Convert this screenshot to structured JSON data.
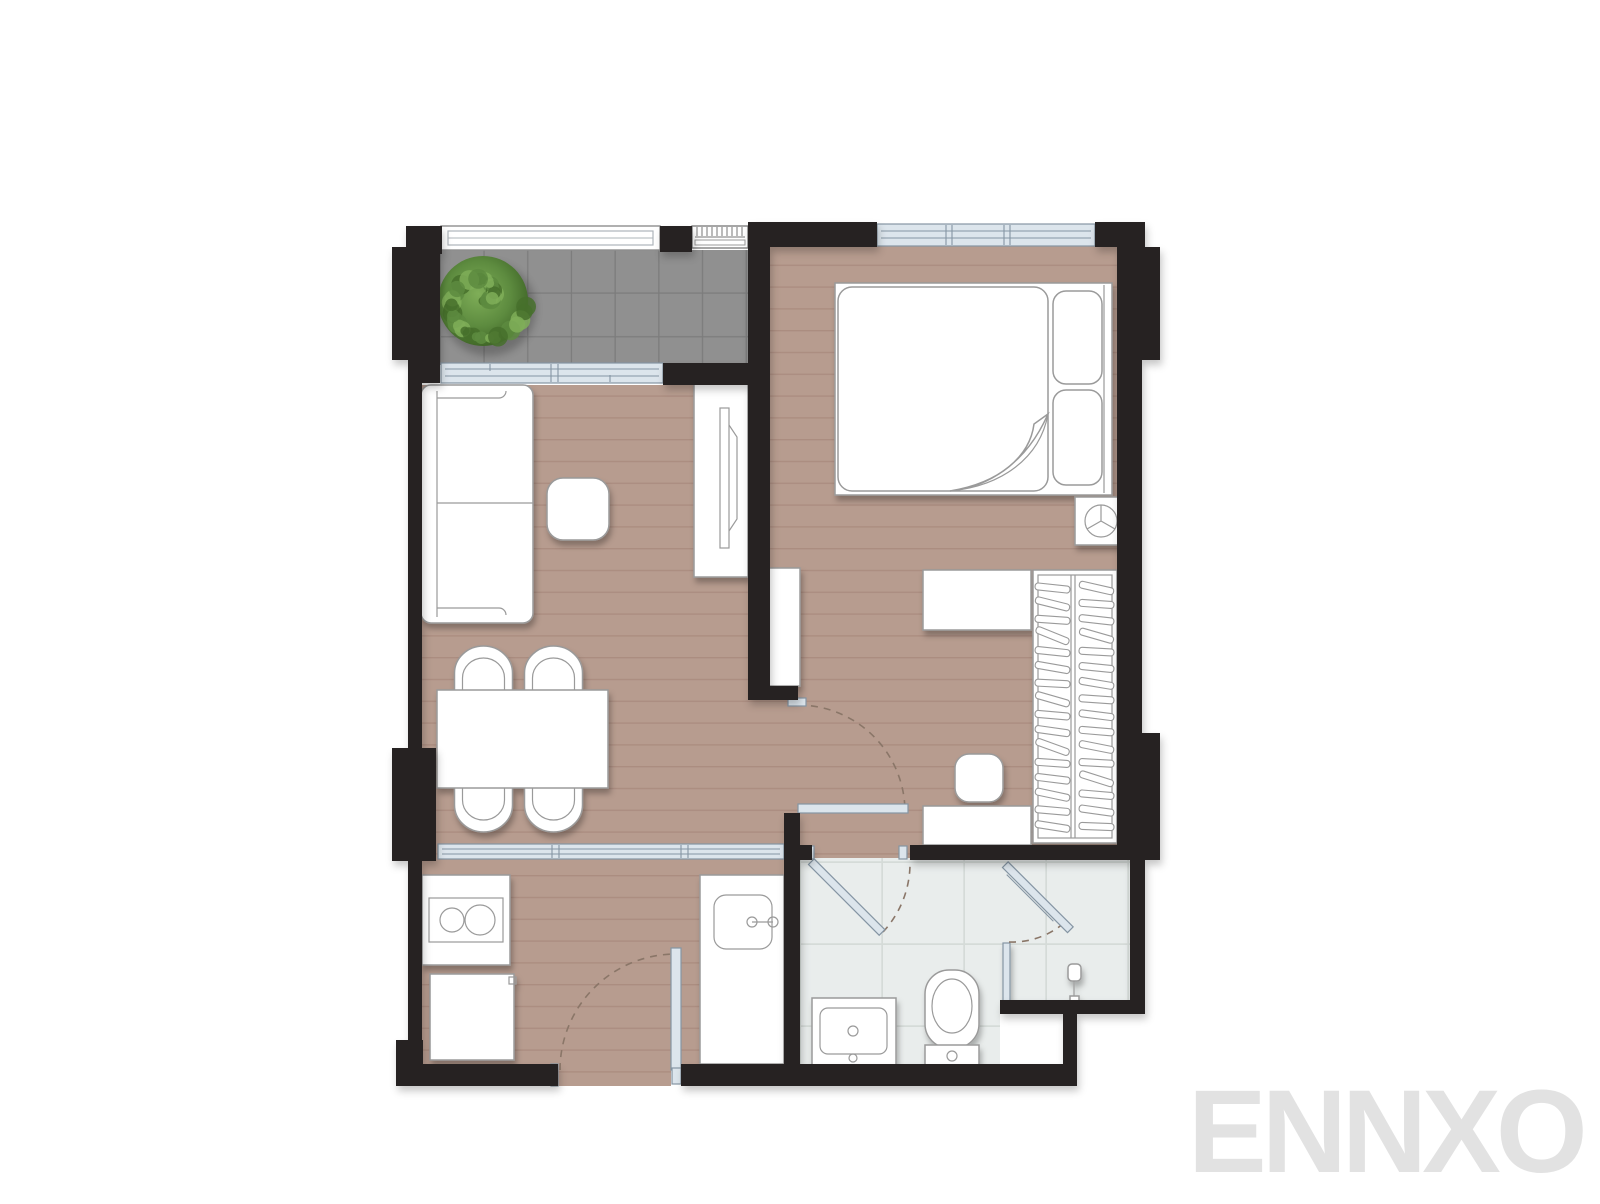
{
  "meta": {
    "watermark": "ENNXO",
    "drawing_type": "apartment-floor-plan",
    "visible_text_other_than_watermark": ""
  },
  "palette": {
    "wall": "#272320",
    "wood": "#b79c8f",
    "wood_line": "#a98b7e",
    "tile": "#909090",
    "tile_line": "#7c7c7c",
    "bath": "#e9edec",
    "bath_line": "#d5dbd8",
    "glass": "#dce5ec",
    "glass_frame": "#8595a3",
    "furn_line": "#9a9a9a",
    "dash": "#8a7668",
    "plant_dark": "#46702c",
    "plant_mid": "#5d8b3f",
    "plant_light": "#7fae58",
    "watermark": "#e2e2e2"
  },
  "rooms": [
    {
      "name": "balcony",
      "floor": "gray-tile",
      "items": [
        "potted-shrub-icon",
        "glass-railing",
        "ac-condenser-icon",
        "sliding-window"
      ]
    },
    {
      "name": "living-dining-room",
      "floor": "wood-plank",
      "items": [
        "sofa-icon",
        "coffee-table-icon",
        "tv-console-icon",
        "tv-icon",
        "dining-table-icon",
        "dining-chair-icon",
        "dining-chair-icon",
        "dining-chair-icon",
        "dining-chair-icon",
        "glass-partition"
      ]
    },
    {
      "name": "bedroom",
      "floor": "wood-plank",
      "items": [
        "double-bed-icon",
        "pillow-icon",
        "pillow-icon",
        "folded-duvet-corner",
        "nightstand-icon",
        "decor-plate-icon",
        "desk-icon",
        "stool-icon",
        "dresser-icon",
        "wardrobe-with-hangers-icon",
        "shelf-icon",
        "swing-door",
        "window"
      ]
    },
    {
      "name": "kitchen",
      "floor": "wood-plank",
      "items": [
        "two-burner-hob-icon",
        "base-cabinet-icon",
        "sink-counter-icon",
        "kitchen-sink-icon",
        "entrance-swing-door"
      ]
    },
    {
      "name": "bathroom",
      "floor": "light-tile",
      "items": [
        "vanity-basin-icon",
        "toilet-icon",
        "shower-head-icon",
        "shower-glass-door",
        "glass-partition",
        "swing-door"
      ]
    }
  ]
}
